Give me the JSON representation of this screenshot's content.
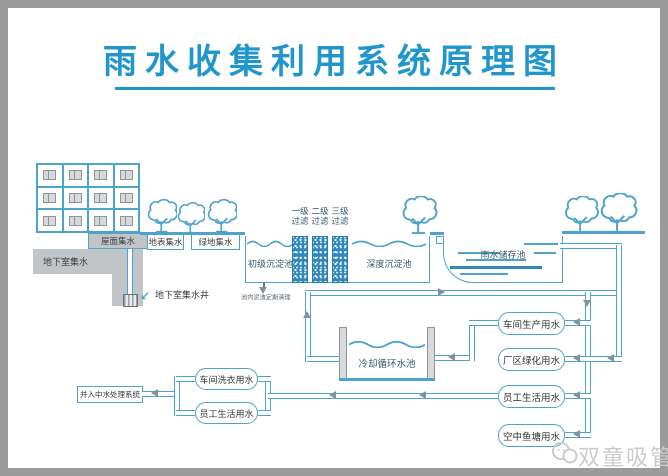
{
  "title": "雨水收集利用系统原理图",
  "collection": {
    "basement_label": "地下室集水",
    "roof_label": "屋面集水",
    "surface_label": "地表集水",
    "green_label": "绿地集水",
    "well_label": "地下室集水井"
  },
  "treatment": {
    "primary_tank": "初级沉淀池",
    "deep_tank": "深度沉淀池",
    "storage_tank": "雨水储存池",
    "filter_stage1": "一级\n过滤",
    "filter_stage2": "二级\n过滤",
    "filter_stage3": "三级\n过滤",
    "sludge_note": "池内泥渣定期清理",
    "cooling_tank": "冷却循环水池"
  },
  "usage": {
    "workshop_production": "车间生产用水",
    "factory_greening": "厂区绿化用水",
    "employee_living": "员工生活用水",
    "sky_fish_pond": "空中鱼塘用水"
  },
  "recycle": {
    "reclaimed_water_system": "并入中水处理系统",
    "workshop_laundry": "车间洗衣用水",
    "employee_living": "员工生活用水"
  },
  "watermark": "双童吸管",
  "colors": {
    "line_blue": "#4da3cc",
    "title_blue": "#2196cd",
    "filter_fill": "#2f88ba",
    "gray_fill": "#c2c5c7",
    "frame_gray": "#9b9b9b",
    "watermark_gray": "#c9cbcd"
  }
}
